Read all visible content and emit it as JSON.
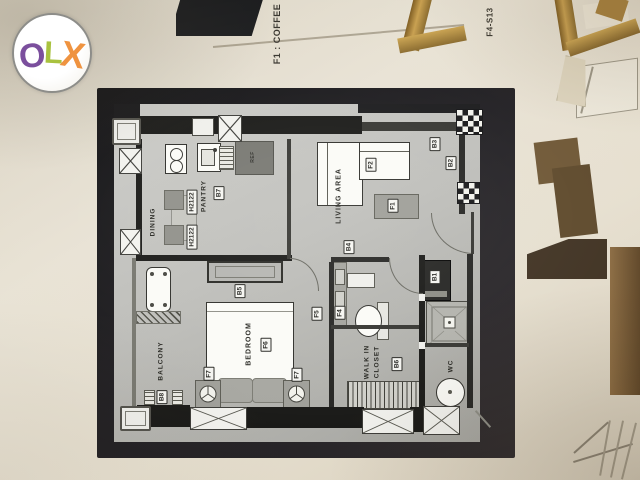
{
  "branding": {
    "logo_o": "O",
    "logo_l": "L",
    "logo_x": "X"
  },
  "captions": {
    "top_left": "F1 : COFFEE",
    "top_right": "F4-S13"
  },
  "floor_plan": {
    "rooms": {
      "dining": "DINING",
      "pantry": "PANTRY",
      "living": "LIVING AREA",
      "bedroom": "BEDROOM",
      "balcony": "BALCONY",
      "walk_in_closet_line1": "WALK IN",
      "walk_in_closet_line2": "CLOSET",
      "wc": "WC"
    },
    "appliances": {
      "fridge": "REF"
    },
    "tags": {
      "h2122_a": "H2122",
      "h2122_b": "H2122",
      "b7": "B7",
      "f2": "F2",
      "f1": "F1",
      "b3": "B3",
      "b2": "B2",
      "b4": "B4",
      "b5": "B5",
      "f5": "F5",
      "f4": "F4",
      "f6": "F6",
      "f7_a": "F7",
      "f7_b": "F7",
      "b8": "B8",
      "b6": "B6",
      "b1": "B1"
    }
  },
  "colors": {
    "background_cream": "#e8e2d4",
    "board_black": "#1d1c1e",
    "paper_gray": "#bfbfbb",
    "logo_o_purple": "#7b4f9d",
    "logo_l_green": "#a9c23f",
    "logo_x_orange": "#ef9340",
    "frame_gold": "#b98e44"
  }
}
